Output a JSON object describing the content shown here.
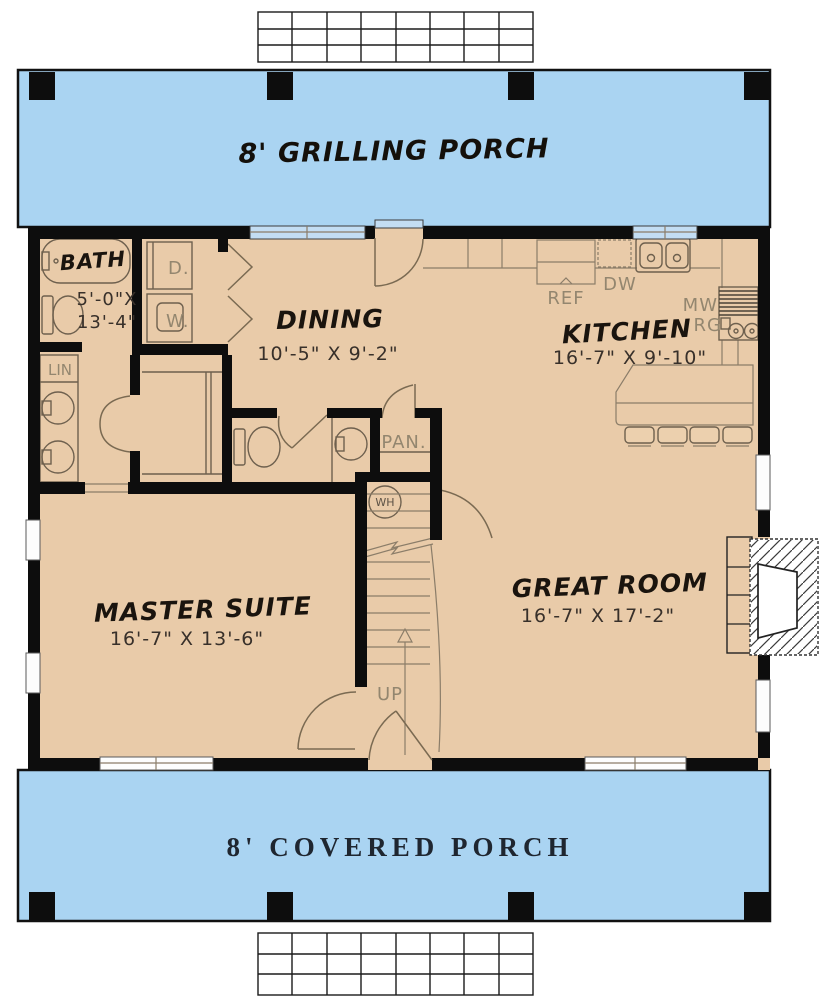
{
  "porches": {
    "grilling": {
      "label": "8' GRILLING PORCH"
    },
    "covered": {
      "label": "8' COVERED PORCH"
    }
  },
  "rooms": {
    "bath": {
      "name": "BATH",
      "dim_line1": "5'-0\"X",
      "dim_line2": "13'-4\""
    },
    "dining": {
      "name": "DINING",
      "dims": "10'-5\" X 9'-2\""
    },
    "kitchen": {
      "name": "KITCHEN",
      "dims": "16'-7\" X 9'-10\""
    },
    "master": {
      "name": "MASTER SUITE",
      "dims": "16'-7\" X 13'-6\""
    },
    "great": {
      "name": "GREAT ROOM",
      "dims": "16'-7\" X 17'-2\""
    }
  },
  "fixtures": {
    "ref": "REF",
    "dw": "DW",
    "mw": "MW",
    "rg": "RG",
    "dryer": "D.",
    "washer": "W.",
    "wh": "WH",
    "lin": "LIN",
    "pantry": "PAN.",
    "up": "UP"
  },
  "colors": {
    "porch": "#aad4f2",
    "floor": "#e9cba9",
    "wall": "#0d0d0d",
    "fixture_line": "#6e604e",
    "cabinet_line": "#8b7d69",
    "label_text": "#93866f",
    "dim_text": "#38302a",
    "room_text": "#1a140e",
    "porch_serif_text": "#1f2630"
  }
}
